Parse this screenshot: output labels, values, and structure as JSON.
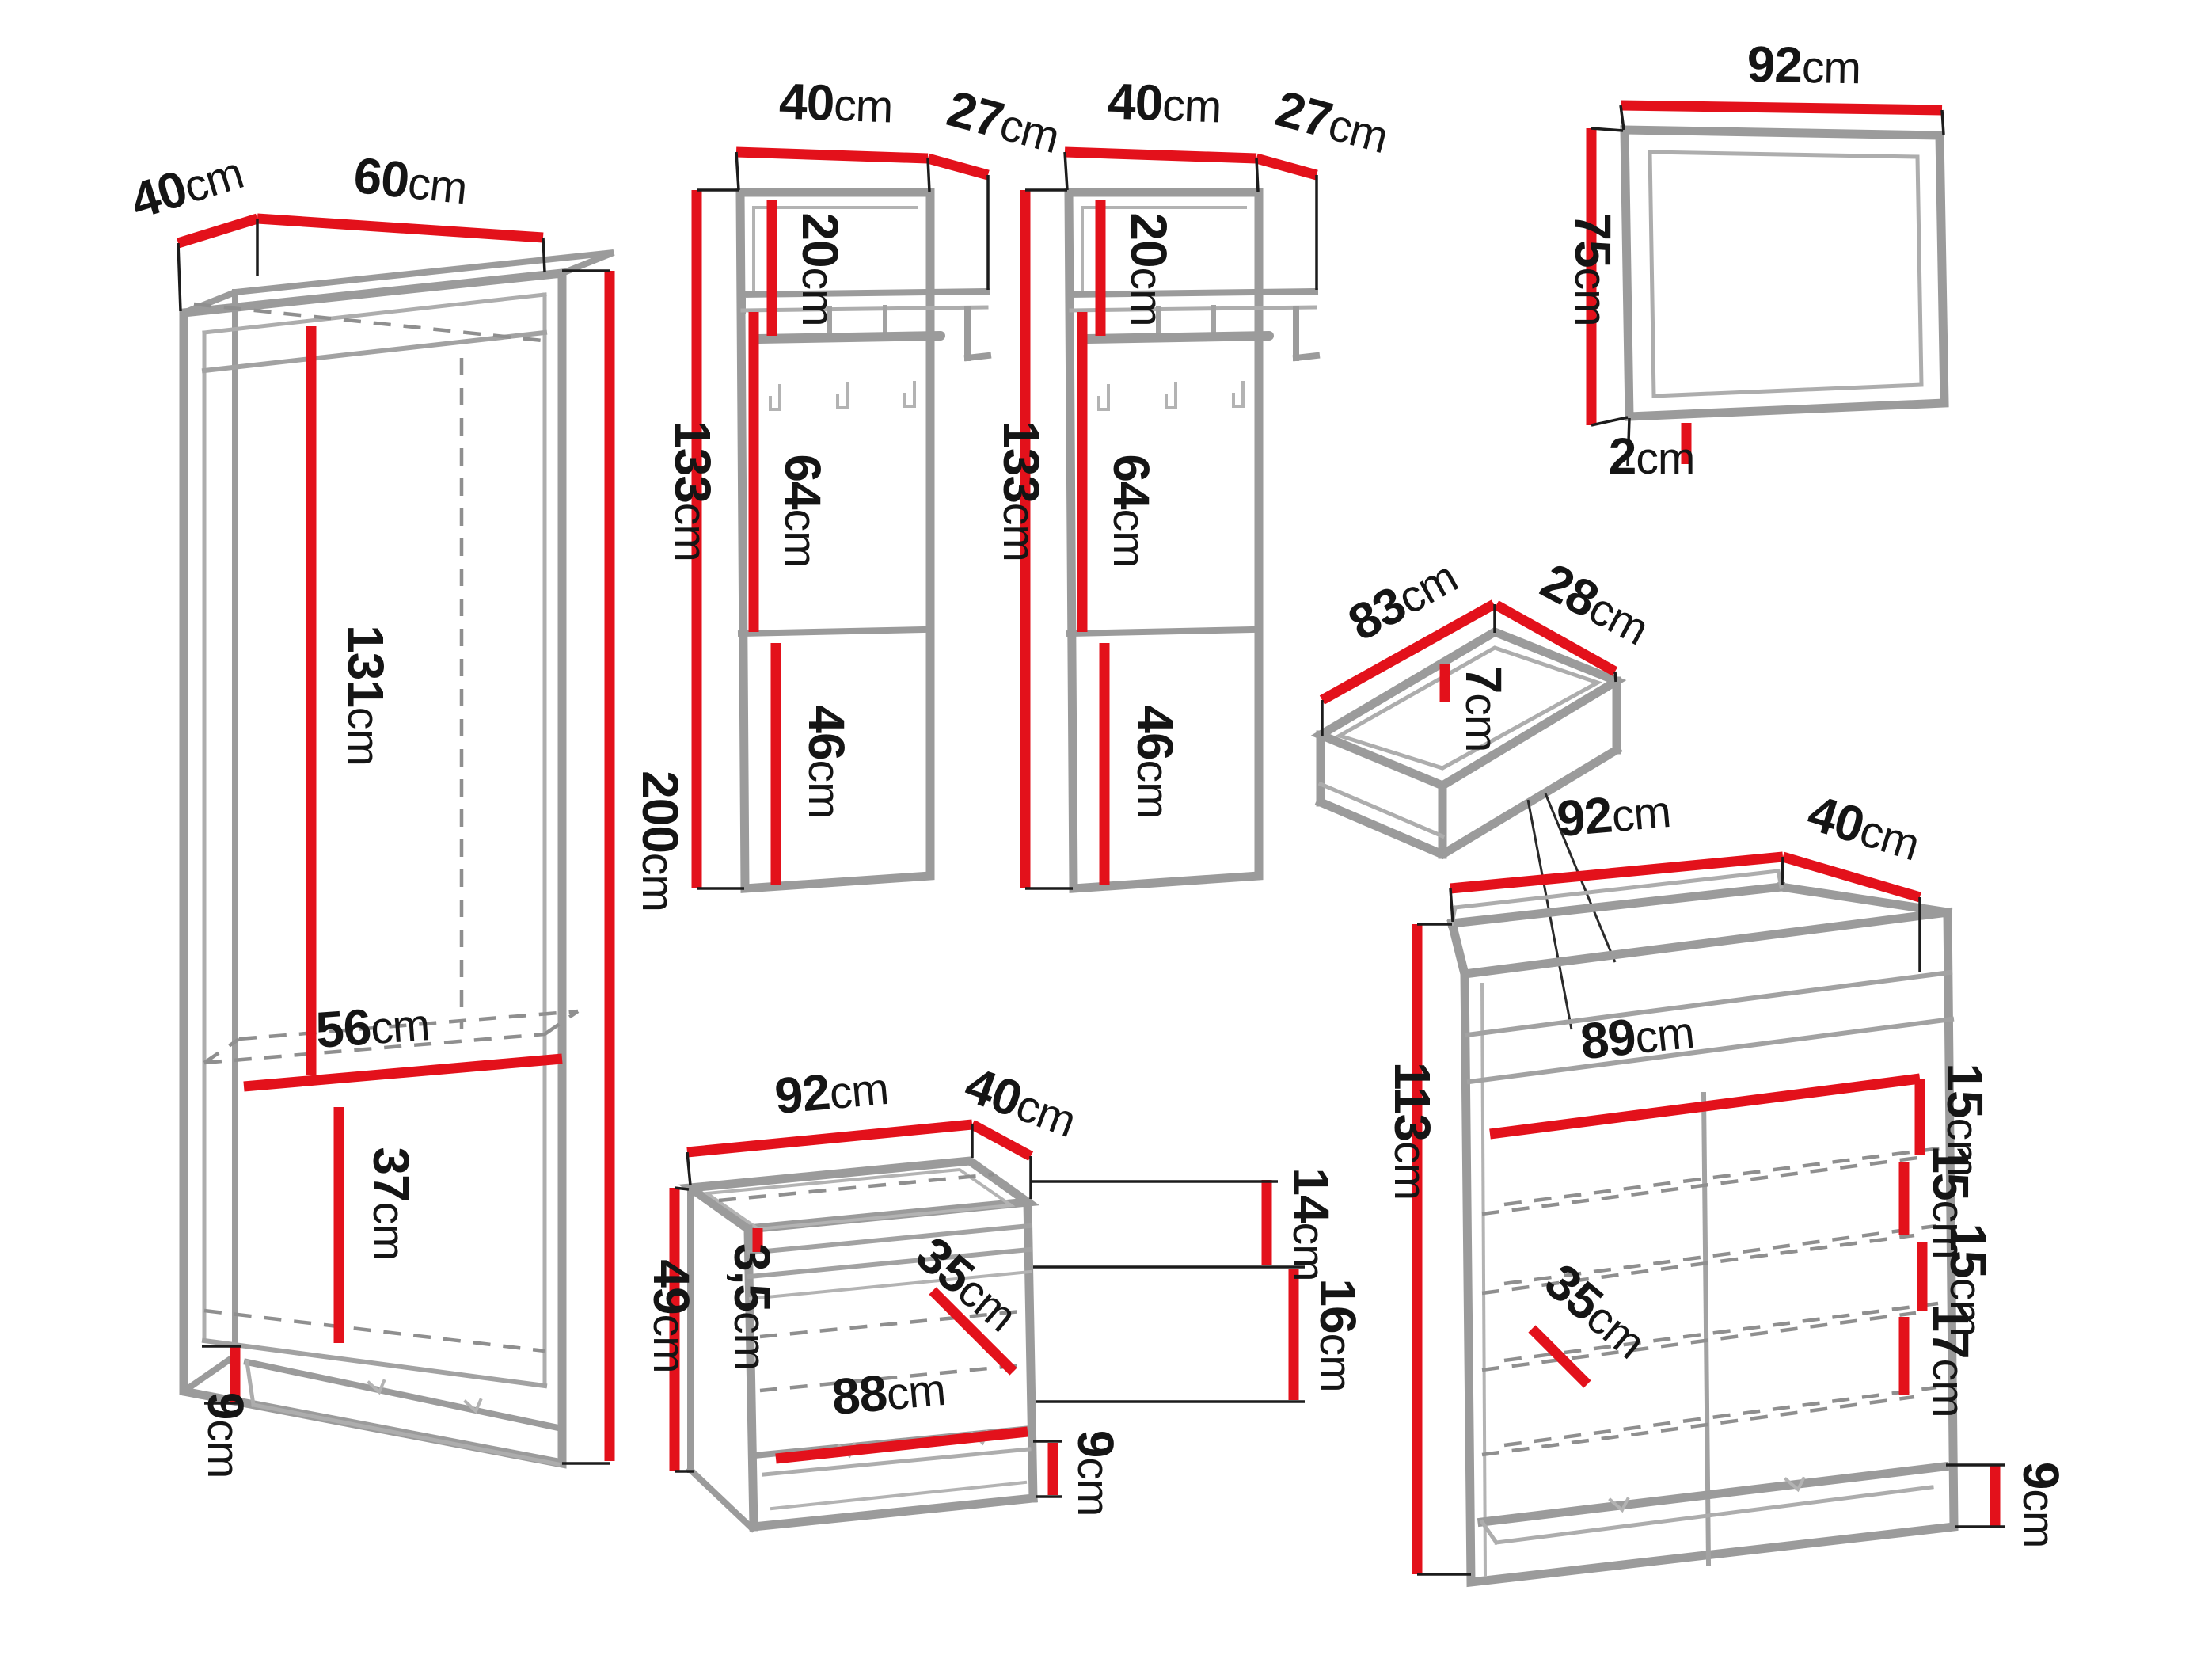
{
  "unit": "cm",
  "colors": {
    "dimension": "#e3111b",
    "outline": "#9b9b9b",
    "text": "#151515",
    "background": "#ffffff"
  },
  "wardrobe": {
    "depth": "40",
    "width": "60",
    "height": "200",
    "hanging": "131",
    "shelf_width": "56",
    "lower": "37",
    "plinth": "9"
  },
  "panel1": {
    "width": "40",
    "shelf_depth": "27",
    "top": "20",
    "height": "133",
    "middle": "64",
    "bottom": "46"
  },
  "panel2": {
    "width": "40",
    "shelf_depth": "27",
    "top": "20",
    "height": "133",
    "middle": "64",
    "bottom": "46"
  },
  "mirror": {
    "width": "92",
    "height": "75",
    "depth": "2"
  },
  "drawer": {
    "width": "83",
    "depth": "28",
    "height": "7"
  },
  "bench": {
    "width": "92",
    "depth": "40",
    "height": "49",
    "seat_thickness": "3,5",
    "upper_right": "14",
    "lower_right": "16",
    "diagonal": "35",
    "inner_width": "88",
    "plinth": "9"
  },
  "chest": {
    "width": "92",
    "depth": "40",
    "height": "113",
    "inner_width": "89",
    "shelf1": "15",
    "shelf2": "15",
    "shelf3": "15",
    "shelf4": "17",
    "diagonal": "35",
    "plinth": "9"
  }
}
